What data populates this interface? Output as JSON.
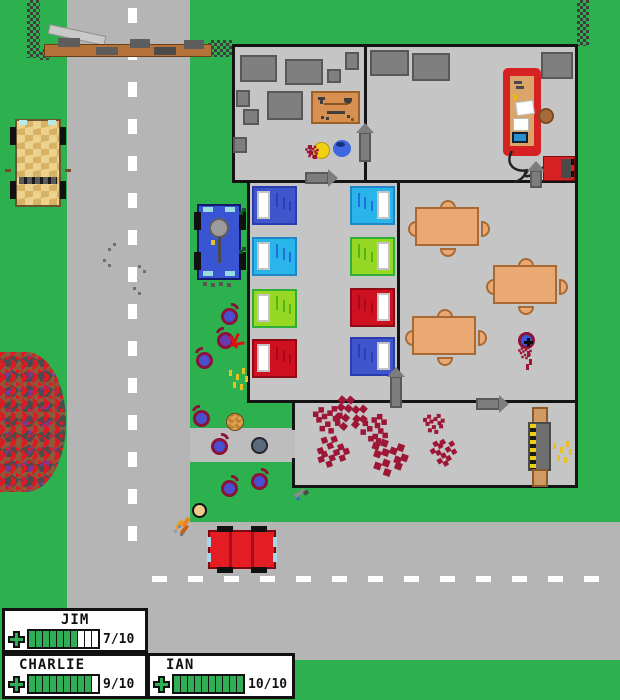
{
  "hud": {
    "players": [
      {
        "name": "JIM",
        "hp": 7,
        "max": 10,
        "hp_label": "7/10"
      },
      {
        "name": "CHARLIE",
        "hp": 9,
        "max": 10,
        "hp_label": "9/10"
      },
      {
        "name": "IAN",
        "hp": 10,
        "max": 10,
        "hp_label": "10/10"
      }
    ]
  },
  "colors": {
    "grass": "#2cb14e",
    "road": "#b5b5b5",
    "floor": "#c5c5c5",
    "wall": "#141414",
    "blood": "#9e1636",
    "hud_green": "#2fae55",
    "zombie_blue": "#4a4fd0",
    "zombie_outline": "#8c1238",
    "bed_royal": "#3f55cc",
    "bed_cyan": "#29b5e9",
    "bed_lime": "#97d824",
    "bed_red": "#cf1020",
    "table_tan": "#eaa973",
    "bench_red": "#d62222",
    "truck_tan": "#ecd28c",
    "car_blue": "#3a55d4",
    "car_red": "#e41c24"
  },
  "entities": {
    "crates": [
      [
        240,
        55,
        37,
        27
      ],
      [
        285,
        59,
        38,
        26
      ],
      [
        345,
        52,
        14,
        18
      ],
      [
        327,
        69,
        14,
        14
      ],
      [
        236,
        90,
        14,
        17
      ],
      [
        267,
        91,
        36,
        29
      ],
      [
        243,
        109,
        16,
        16
      ],
      [
        233,
        137,
        14,
        16
      ],
      [
        370,
        50,
        39,
        26
      ],
      [
        412,
        53,
        38,
        28
      ],
      [
        541,
        52,
        32,
        27
      ]
    ],
    "beds": [
      {
        "x": 252,
        "y": 186,
        "c": "royal",
        "p": "L"
      },
      {
        "x": 252,
        "y": 237,
        "c": "cyan",
        "p": "L"
      },
      {
        "x": 252,
        "y": 289,
        "c": "lime",
        "p": "L"
      },
      {
        "x": 252,
        "y": 339,
        "c": "red",
        "p": "L"
      },
      {
        "x": 350,
        "y": 186,
        "c": "cyan",
        "p": "R"
      },
      {
        "x": 350,
        "y": 237,
        "c": "lime",
        "p": "R"
      },
      {
        "x": 350,
        "y": 288,
        "c": "red",
        "p": "R"
      },
      {
        "x": 350,
        "y": 337,
        "c": "royal",
        "p": "R"
      }
    ],
    "tables": [
      [
        415,
        207
      ],
      [
        493,
        265
      ],
      [
        412,
        316
      ]
    ],
    "zombies": [
      {
        "x": 221,
        "y": 308,
        "v": "blue",
        "f": "tr"
      },
      {
        "x": 217,
        "y": 332,
        "v": "purple",
        "f": "tl",
        "flash": true
      },
      {
        "x": 196,
        "y": 352,
        "v": "blue",
        "f": "tl"
      },
      {
        "x": 193,
        "y": 410,
        "v": "blue",
        "f": "tl"
      },
      {
        "x": 211,
        "y": 438,
        "v": "blue",
        "f": "tr"
      },
      {
        "x": 251,
        "y": 437,
        "v": "gray",
        "f": "none"
      },
      {
        "x": 221,
        "y": 480,
        "v": "blue",
        "f": "tr"
      },
      {
        "x": 251,
        "y": 473,
        "v": "blue",
        "f": "tr"
      },
      {
        "x": 518,
        "y": 332,
        "v": "cross",
        "f": "none"
      }
    ],
    "survivors": [
      {
        "x": 313,
        "y": 142,
        "kind": "yellow"
      },
      {
        "x": 333,
        "y": 140,
        "kind": "blue"
      },
      {
        "x": 226,
        "y": 413,
        "kind": "head"
      },
      {
        "x": 192,
        "y": 503,
        "kind": "shooter"
      }
    ],
    "vehicles": [
      {
        "kind": "truck",
        "x": 12,
        "y": 117
      },
      {
        "kind": "bluecar",
        "x": 195,
        "y": 200
      },
      {
        "kind": "redcar",
        "x": 205,
        "y": 526
      }
    ],
    "items": [
      {
        "kind": "workbench",
        "x": 311,
        "y": 91
      },
      {
        "kind": "benchred",
        "x": 503,
        "y": 68
      },
      {
        "kind": "stool",
        "x": 538,
        "y": 108
      },
      {
        "kind": "generator",
        "x": 543,
        "y": 156
      },
      {
        "kind": "machine",
        "x": 528,
        "y": 407
      },
      {
        "kind": "gun",
        "x": 294,
        "y": 486
      }
    ],
    "door_arrows": [
      [
        305,
        172,
        "r"
      ],
      [
        359,
        132,
        "u",
        26
      ],
      [
        390,
        376,
        "u",
        28
      ],
      [
        476,
        398,
        "r"
      ],
      [
        530,
        170,
        "u",
        14
      ]
    ],
    "splats": [
      [
        322,
        414,
        1.1,
        0
      ],
      [
        346,
        406,
        1.3,
        40
      ],
      [
        375,
        423,
        1.1,
        90
      ],
      [
        429,
        419,
        0.8,
        0
      ],
      [
        334,
        450,
        1.2,
        160
      ],
      [
        383,
        450,
        1.4,
        20
      ],
      [
        441,
        453,
        1.0,
        240
      ],
      [
        521,
        349,
        0.5,
        0
      ],
      [
        308,
        148,
        0.5,
        0
      ]
    ],
    "sparks": [
      [
        553,
        443
      ],
      [
        229,
        370
      ]
    ],
    "footprints": [
      [
        108,
        248
      ],
      [
        113,
        243
      ],
      [
        103,
        259
      ],
      [
        108,
        264
      ],
      [
        138,
        265
      ],
      [
        143,
        270
      ],
      [
        133,
        287
      ],
      [
        138,
        292
      ]
    ],
    "sprigs": [
      [
        239,
        211
      ],
      [
        239,
        250
      ]
    ]
  }
}
